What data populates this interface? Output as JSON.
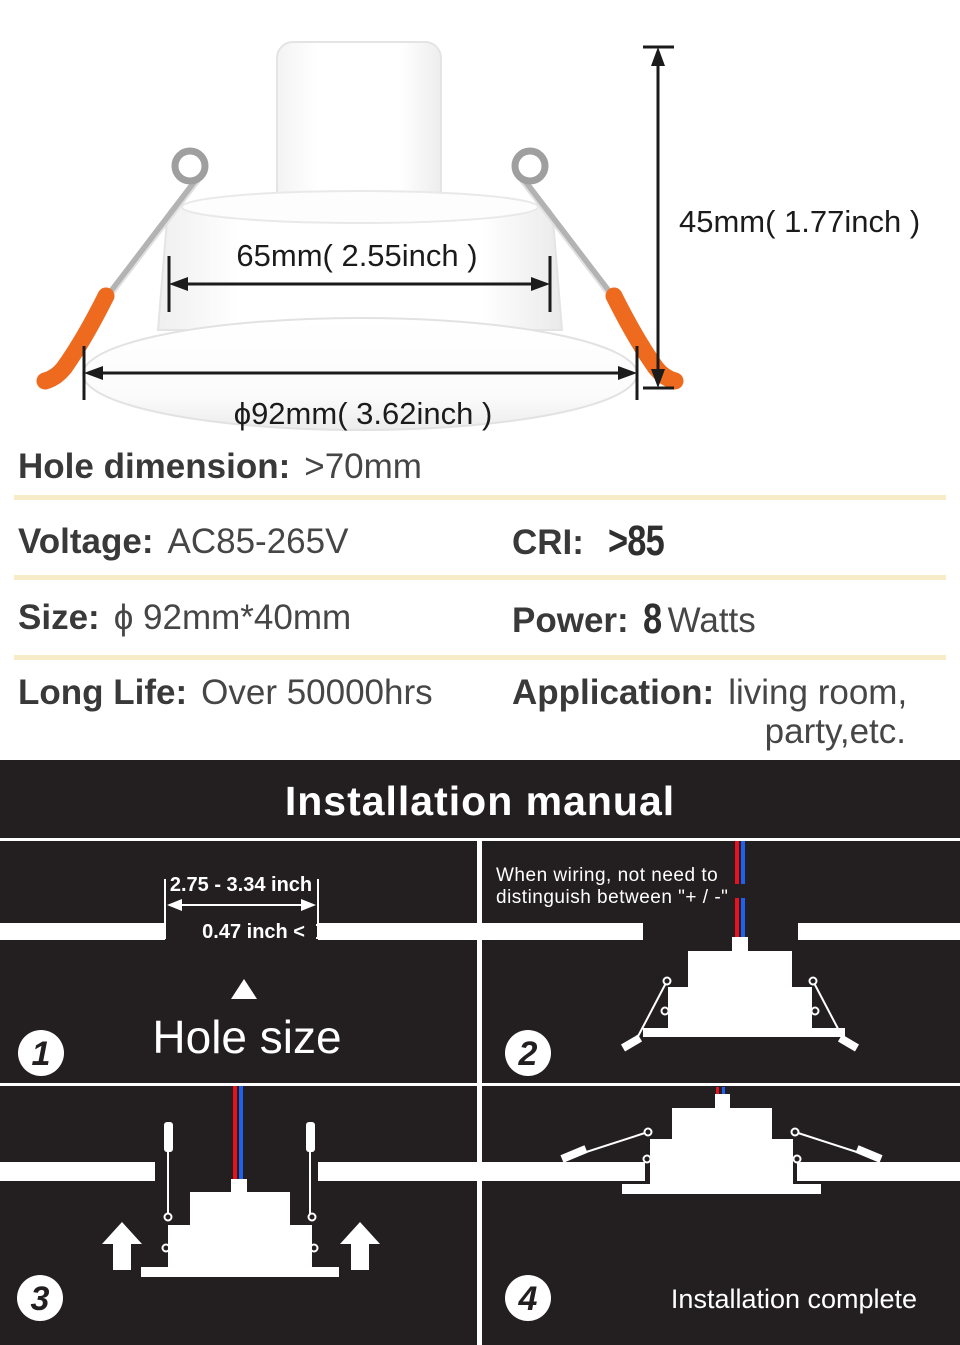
{
  "diagram": {
    "body_width_label": "65mm( 2.55inch )",
    "flange_width_label": "ϕ92mm( 3.62inch )",
    "height_label": "45mm( 1.77inch )"
  },
  "specs": {
    "hole_dimension": {
      "label": "Hole dimension:",
      "value": ">70mm"
    },
    "voltage": {
      "label": "Voltage:",
      "value": "AC85-265V"
    },
    "cri": {
      "label": "CRI:",
      "value": ">85"
    },
    "size": {
      "label": "Size:",
      "value": "ϕ 92mm*40mm"
    },
    "power": {
      "label": "Power:",
      "value_number": "8",
      "value_unit": "Watts"
    },
    "long_life": {
      "label": "Long Life:",
      "value": "Over 50000hrs"
    },
    "application": {
      "label": "Application:",
      "value_line1": "living room,",
      "value_line2": "party,etc."
    }
  },
  "manual": {
    "title": "Installation manual",
    "steps": [
      {
        "number": "1",
        "dim_width": "2.75 - 3.34 inch",
        "dim_thickness": "0.47 inch <",
        "caption": "Hole size"
      },
      {
        "number": "2",
        "note_line1": "When wiring, not need to",
        "note_line2": "distinguish between \"+ / -\""
      },
      {
        "number": "3"
      },
      {
        "number": "4",
        "caption": "Installation complete"
      }
    ]
  },
  "colors": {
    "accent_orange": "#ed6a1f",
    "wire_red": "#e8111c",
    "wire_blue": "#2060ef",
    "separator_cream": "#f8ebc8",
    "manual_background": "#231e1f",
    "text_dark": "#3c3c3d"
  }
}
